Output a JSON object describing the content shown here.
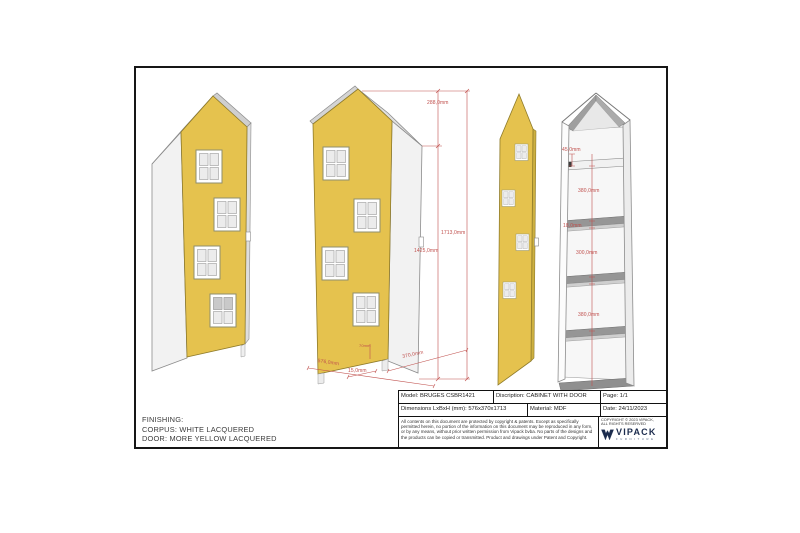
{
  "colors": {
    "door_yellow": "#e5c24e",
    "dimension_red": "#c0504d",
    "logo_navy": "#1b2b4d"
  },
  "dimensions": {
    "front": {
      "roof_height": "288,0mm",
      "total_height": "1713,0mm",
      "door_height": "1425,0mm",
      "depth": "370,0mm",
      "width": "576,0mm",
      "door_inset": "15,0mm",
      "plinth_height": "70mm"
    },
    "interior": {
      "top_offset": "45,0mm",
      "top_compartment": "380,0mm",
      "shelf_thickness_upper": "18,0mm",
      "middle_compartment": "300,0mm",
      "shelf_thickness_lower": "18,0mm",
      "bottom_compartment": "380,0mm"
    }
  },
  "finishing": {
    "title": "FINISHING:",
    "corpus": "CORPUS: WHITE LACQUERED",
    "door": "DOOR: MORE YELLOW LACQUERED"
  },
  "title_block": {
    "model": "Model: BRUGES CSBR1421",
    "description": "Discription: CABINET WITH DOOR",
    "page": "Page: 1/1",
    "dimensions": "Dimensions LxBxH (mm): 576x370x1713",
    "material": "Material: MDF",
    "date": "Date: 24/11/2023",
    "legal": "All contents on this document are protected by copyright & patents. Except as specifically permitted herein, no portion of the information on this document may be reproduced in any form, or by any means, without prior written permission from Vipack bvba. No parts of the designs and the products can be copied or transmitted. Product and drawings under Patent and Copyright.",
    "copyright_line1": "COPYRIGHT © 2023 VIPACK,",
    "copyright_line2": "ALL RIGHTS RESERVED",
    "logo_text": "VIPACK",
    "logo_sub": "FURNITURE"
  }
}
